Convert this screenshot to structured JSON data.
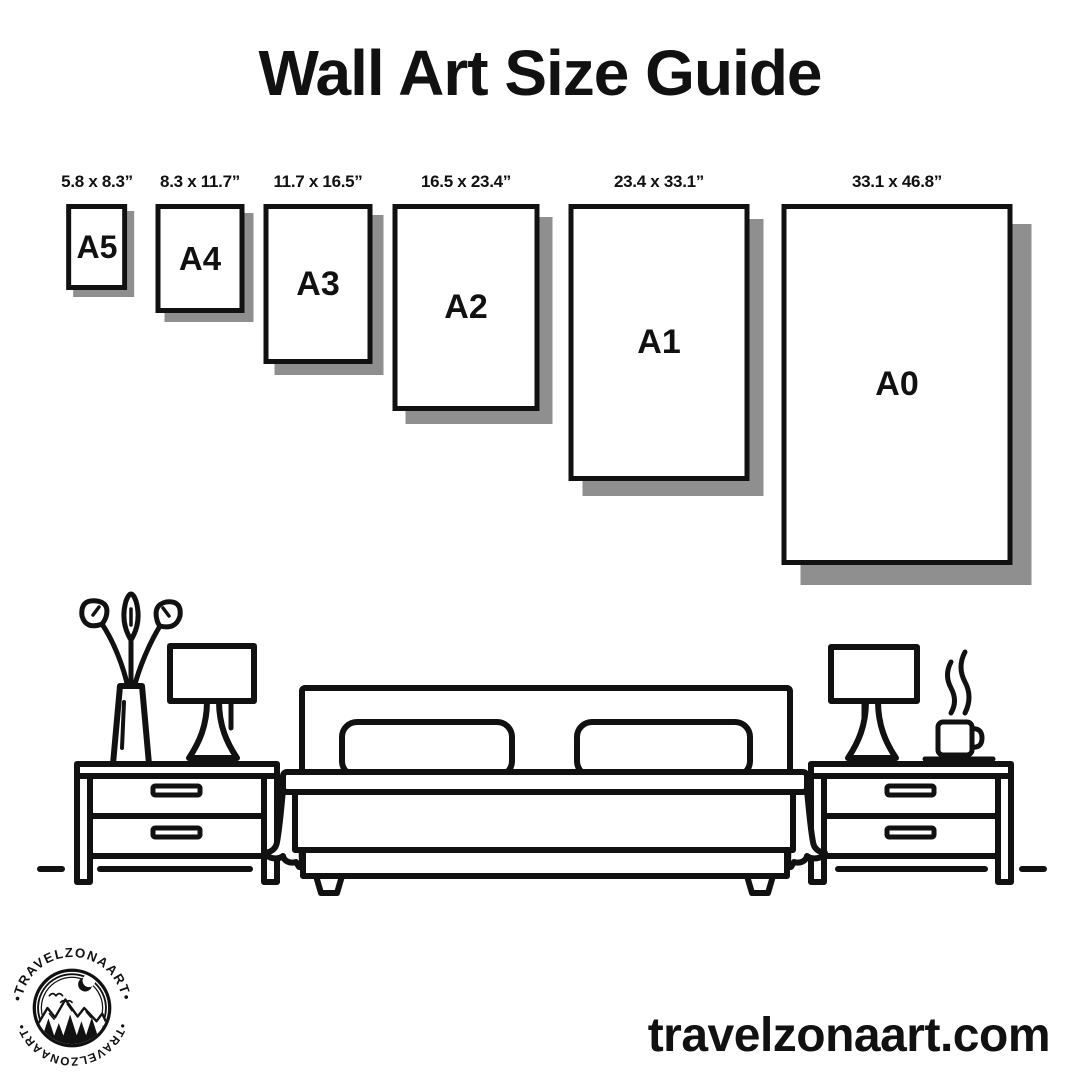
{
  "title": "Wall Art Size Guide",
  "sizes": {
    "items": [
      {
        "code": "A5",
        "dimensions": "5.8 x 8.3”"
      },
      {
        "code": "A4",
        "dimensions": "8.3 x 11.7”"
      },
      {
        "code": "A3",
        "dimensions": "11.7 x 16.5”"
      },
      {
        "code": "A2",
        "dimensions": "16.5 x 23.4”"
      },
      {
        "code": "A1",
        "dimensions": "23.4 x 33.1”"
      },
      {
        "code": "A0",
        "dimensions": "33.1 x 46.8”"
      }
    ]
  },
  "logo": {
    "arc_text_top": "•TRAVELZONAART•",
    "arc_text_bottom": "•TRAVELZONAART•"
  },
  "footer": {
    "website": "travelzonaart.com"
  },
  "colors": {
    "ink": "#111111",
    "shadow": "#8f8f8f",
    "background": "#ffffff"
  }
}
